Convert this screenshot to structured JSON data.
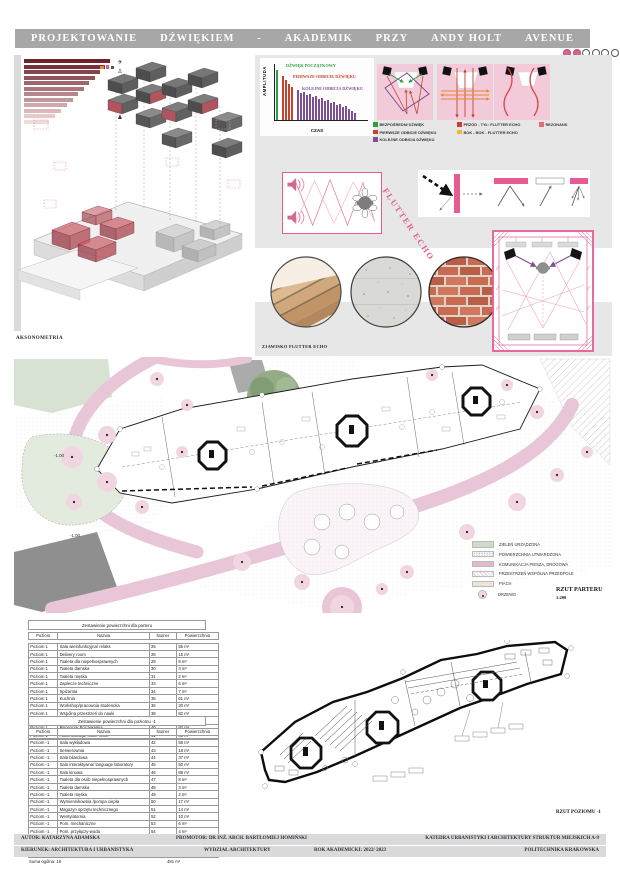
{
  "title": {
    "words": [
      "PROJEKTOWANIE",
      "DŹWIĘKIEM",
      "-",
      "AKADEMIK",
      "PRZY",
      "ANDY HOLT",
      "AVENUE"
    ]
  },
  "axonometria": {
    "label": "AKSONOMETRIA"
  },
  "chart_data": [
    {
      "type": "bar",
      "title": "Wykres amplitudy odbić dźwięku w czasie",
      "xlabel": "CZAS",
      "ylabel": "AMPLITUDA",
      "ylim": [
        0,
        100
      ],
      "grid": false,
      "series": [
        {
          "name": "DŹWIĘK POCZĄTKOWY",
          "color": "#2f9e41",
          "values": [
            100
          ]
        },
        {
          "name": "PIERWSZE ODBICIE DŹWIĘKU",
          "color": "#c4432f",
          "values": [
            88,
            80,
            72,
            66
          ]
        },
        {
          "name": "KOLEJNE ODBICIA DŹWIĘKU",
          "color": "#7d4f93",
          "values": [
            60,
            54,
            57,
            50,
            52,
            46,
            48,
            42,
            44,
            38,
            40,
            34,
            36,
            30,
            32,
            26,
            28,
            22,
            18,
            14
          ]
        }
      ]
    },
    {
      "type": "bar",
      "title": "Skala poziomów hałasu (pasek malejący)",
      "orientation": "horizontal",
      "values_relative": [
        100,
        94,
        88,
        82,
        76,
        70,
        63,
        57,
        50,
        43,
        36,
        29
      ],
      "color_start": "#6d222c",
      "color_end": "#f3dada"
    }
  ],
  "acoustics_legend": [
    {
      "label": "BEZPOŚREDNI DŹWIĘK",
      "color": "#2f9e41"
    },
    {
      "label": "PIERWSZE ODBICIE DŹWIĘKU",
      "color": "#c4432f"
    },
    {
      "label": "KOLEJNE ODBICIA DŹWIĘKU",
      "color": "#7d4f93"
    },
    {
      "label": "PRZÓD - TYŁ: FLUTTER ECHO",
      "color": "#c4432f"
    },
    {
      "label": "BOK - BOK - FLUTTER ECHO",
      "color": "#ecb53c"
    },
    {
      "label": "REZONANS",
      "color": "#e07070"
    }
  ],
  "flutter": {
    "label": "FLUTTER ECHO"
  },
  "materials": {
    "caption": "ZJAWISKO FLUTTER ECHO"
  },
  "site_plan": {
    "legend": [
      {
        "label": "ZIELEŃ URZĄDZONA",
        "swatch": "green"
      },
      {
        "label": "POWIERZCHNIA UTWARDZONA",
        "swatch": "paved"
      },
      {
        "label": "KOMUNIKACJA PIESZA, DROGOWA",
        "swatch": "pink"
      },
      {
        "label": "PRZESTRZEŃ WSPÓLNA PRZEDPOLE",
        "swatch": "common"
      },
      {
        "label": "PIACH",
        "swatch": "sand"
      },
      {
        "label": "DRZEWO",
        "swatch": "tree"
      }
    ],
    "elevation_labels": [
      "-1.00",
      "-1.00"
    ],
    "caption": "RZUT PARTERU",
    "scale": "1:200"
  },
  "tables": [
    {
      "title": "Zestawienie powierzchni dla parteru",
      "headers": [
        "Poziom",
        "Nazwa",
        "Numer",
        "Powierzchnia"
      ],
      "rows": [
        [
          "Poziom 1",
          "Sala wielofunkcyjna/ relaks",
          "25",
          "55 m²"
        ],
        [
          "Poziom 1",
          "Delivery room",
          "28",
          "15 m²"
        ],
        [
          "Poziom 1",
          "Toaleta dla niepełnosprawnych",
          "29",
          "8 m²"
        ],
        [
          "Poziom 1",
          "Toaleta damska",
          "30",
          "3 m²"
        ],
        [
          "Poziom 1",
          "Toaleta męska",
          "31",
          "2 m²"
        ],
        [
          "Poziom 1",
          "Zaplecze techniczne",
          "33",
          "6 m²"
        ],
        [
          "Poziom 1",
          "Spiżarnia",
          "34",
          "7 m²"
        ],
        [
          "Poziom 1",
          "Kuchnia",
          "35",
          "61 m²"
        ],
        [
          "Poziom 1",
          "Workshop/pracownia studencka",
          "36",
          "20 m²"
        ],
        [
          "Poziom 1",
          "Wspólna przestrzeń do nauki",
          "38",
          "82 m²"
        ],
        [
          "Poziom 1",
          "Sala konferencyjna",
          "39",
          "41 m²"
        ],
        [
          "Poziom 1",
          "Recepcja/ Poczekalnia",
          "40",
          "92 m²"
        ],
        [
          "Poziom 1",
          "Administracja/ office room",
          "41",
          "48 m²"
        ]
      ],
      "summary": {
        "label": "Suma ogólna: 13",
        "value": "440 m²"
      }
    },
    {
      "title": "Zestawienie powierzchni dla poziomu -1",
      "headers": [
        "Poziom",
        "Nazwa",
        "Numer",
        "Powierzchnia"
      ],
      "rows": [
        [
          "Poziom -1",
          "Sala wykładowa",
          "42",
          "58 m²"
        ],
        [
          "Poziom -1",
          "Serwerownia",
          "43",
          "18 m²"
        ],
        [
          "Poziom -1",
          "Sala bilardowa",
          "44",
          "37 m²"
        ],
        [
          "Poziom -1",
          "Sala interaktywna/ language laboratory",
          "45",
          "50 m²"
        ],
        [
          "Poziom -1",
          "Sala kinowa",
          "46",
          "88 m²"
        ],
        [
          "Poziom -1",
          "Toaleta dla osób niepełnosprawnych",
          "47",
          "8 m²"
        ],
        [
          "Poziom -1",
          "Toaleta damska",
          "48",
          "3 m²"
        ],
        [
          "Poziom -1",
          "Toaleta męska",
          "49",
          "2 m²"
        ],
        [
          "Poziom -1",
          "Wymiennikownia /pompa ciepła",
          "50",
          "17 m²"
        ],
        [
          "Poziom -1",
          "Magazyn sprzętu technicznego",
          "51",
          "14 m²"
        ],
        [
          "Poziom -1",
          "Wentylatornia",
          "52",
          "10 m²"
        ],
        [
          "Poziom -1",
          "Pom. mechaniczne",
          "53",
          "6 m²"
        ],
        [
          "Poziom -1",
          "Pom. przyłączy-woda",
          "54",
          "4 m²"
        ],
        [
          "Poziom -1",
          "Pom. przyłączy-prąd",
          "55",
          "4 m²"
        ],
        [
          "Poziom -1",
          "Księgarnia",
          "56",
          "113 m²"
        ],
        [
          "Poziom -1",
          "Game room",
          "57",
          "49 m²"
        ]
      ],
      "summary": {
        "label": "Suma ogólna: 16",
        "value": "481 m²"
      }
    }
  ],
  "lower_plan": {
    "caption": "RZUT POZIOMU -1"
  },
  "footer": {
    "author": "AUTOR: KATARZYNA ADAMSKA",
    "promoter": "PROMOTOR: DR INŻ. ARCH. BARTŁOMIEJ HOMIŃSKI",
    "department": "KATEDRA URBANISTYKI I ARCHITEKTURY STRUKTUR MIEJSKICH A-9",
    "line2": [
      "KIERUNEK: ARCHITEKTURA I URBANISTYKA",
      "WYDZIAŁ ARCHITEKTURY",
      "ROK AKADEMICKI: 2022/ 2023",
      "POLITECHNIKA KRAKOWSKA"
    ]
  }
}
